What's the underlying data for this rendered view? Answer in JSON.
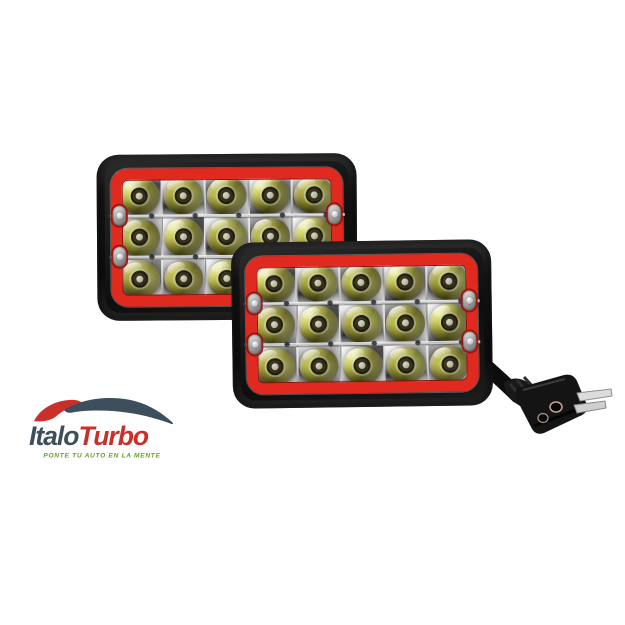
{
  "meta": {
    "description": "Product photo: pair of rectangular 15-LED headlights with red bezels and a power plug on a white background",
    "background_color": "#ffffff"
  },
  "product": {
    "name": "LED headlight pair with red bezel",
    "lights": [
      {
        "id": "rear",
        "label": "rear headlight"
      },
      {
        "id": "front",
        "label": "front headlight"
      }
    ],
    "led_grid": {
      "columns": 5,
      "rows": 3,
      "led_count": 15
    },
    "colors": {
      "housing": "#131313",
      "bezel_red": "#e02a20",
      "lens_olive": "#b2ac35",
      "chrome": "#d8d8d8",
      "cable_black": "#0d0d0d",
      "prong_silver": "#dcdcdc"
    }
  },
  "logo": {
    "italo": "Italo",
    "turbo": "Turbo",
    "tagline": "PONTE TU AUTO EN LA MENTE",
    "colors": {
      "italo": "#3d4f5c",
      "turbo": "#c9302c",
      "tagline": "#63a028"
    }
  }
}
